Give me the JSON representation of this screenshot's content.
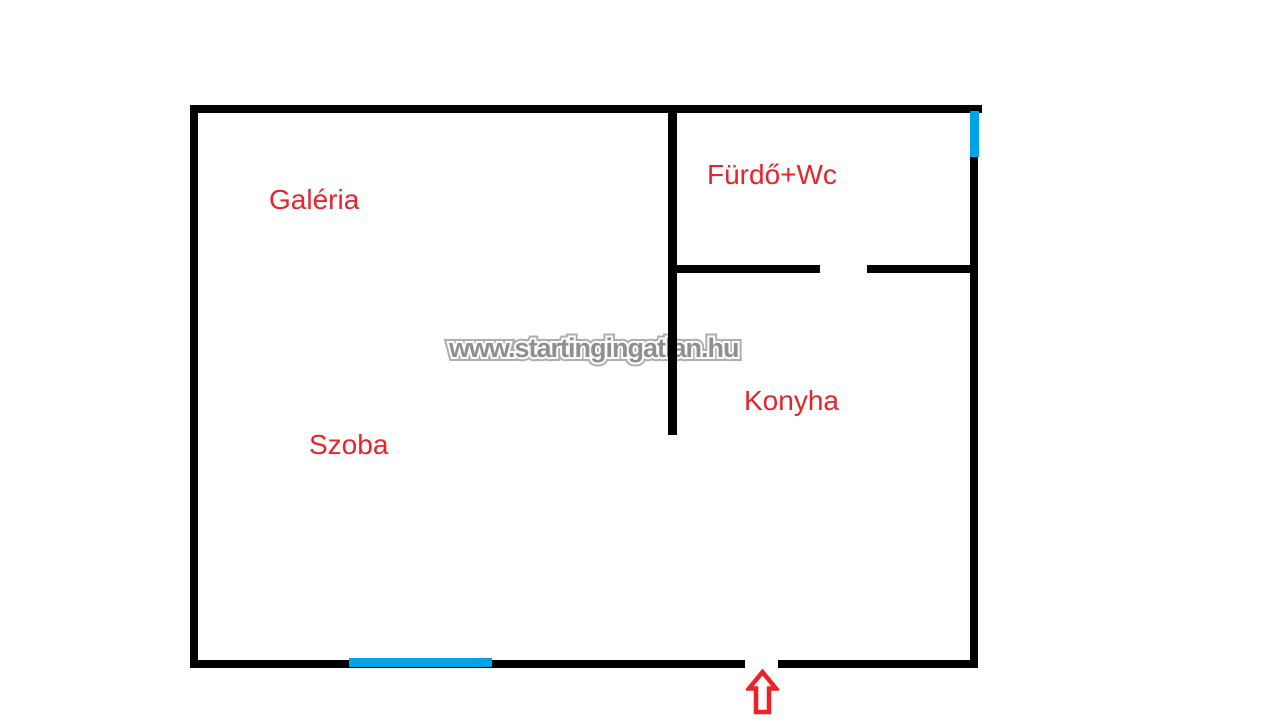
{
  "canvas": {
    "background": "#ffffff",
    "width": 1280,
    "height": 720
  },
  "colors": {
    "wall": "#000000",
    "room_label": "#e8242a",
    "window_marker": "#00a2e8",
    "entrance_arrow": "#ed2228",
    "watermark_core": "#8f8f8f",
    "watermark_halo": "#ffffff",
    "watermark_edge": "#aeaeae"
  },
  "rooms": {
    "galeria": {
      "label": "Galéria"
    },
    "furdo_wc": {
      "label": "Fürdő+Wc"
    },
    "konyha": {
      "label": "Konyha"
    },
    "szoba": {
      "label": "Szoba"
    }
  },
  "watermark": {
    "text": "www.startingingatlan.hu"
  },
  "icons": {
    "entrance_arrow": "hollow-up-arrow"
  }
}
